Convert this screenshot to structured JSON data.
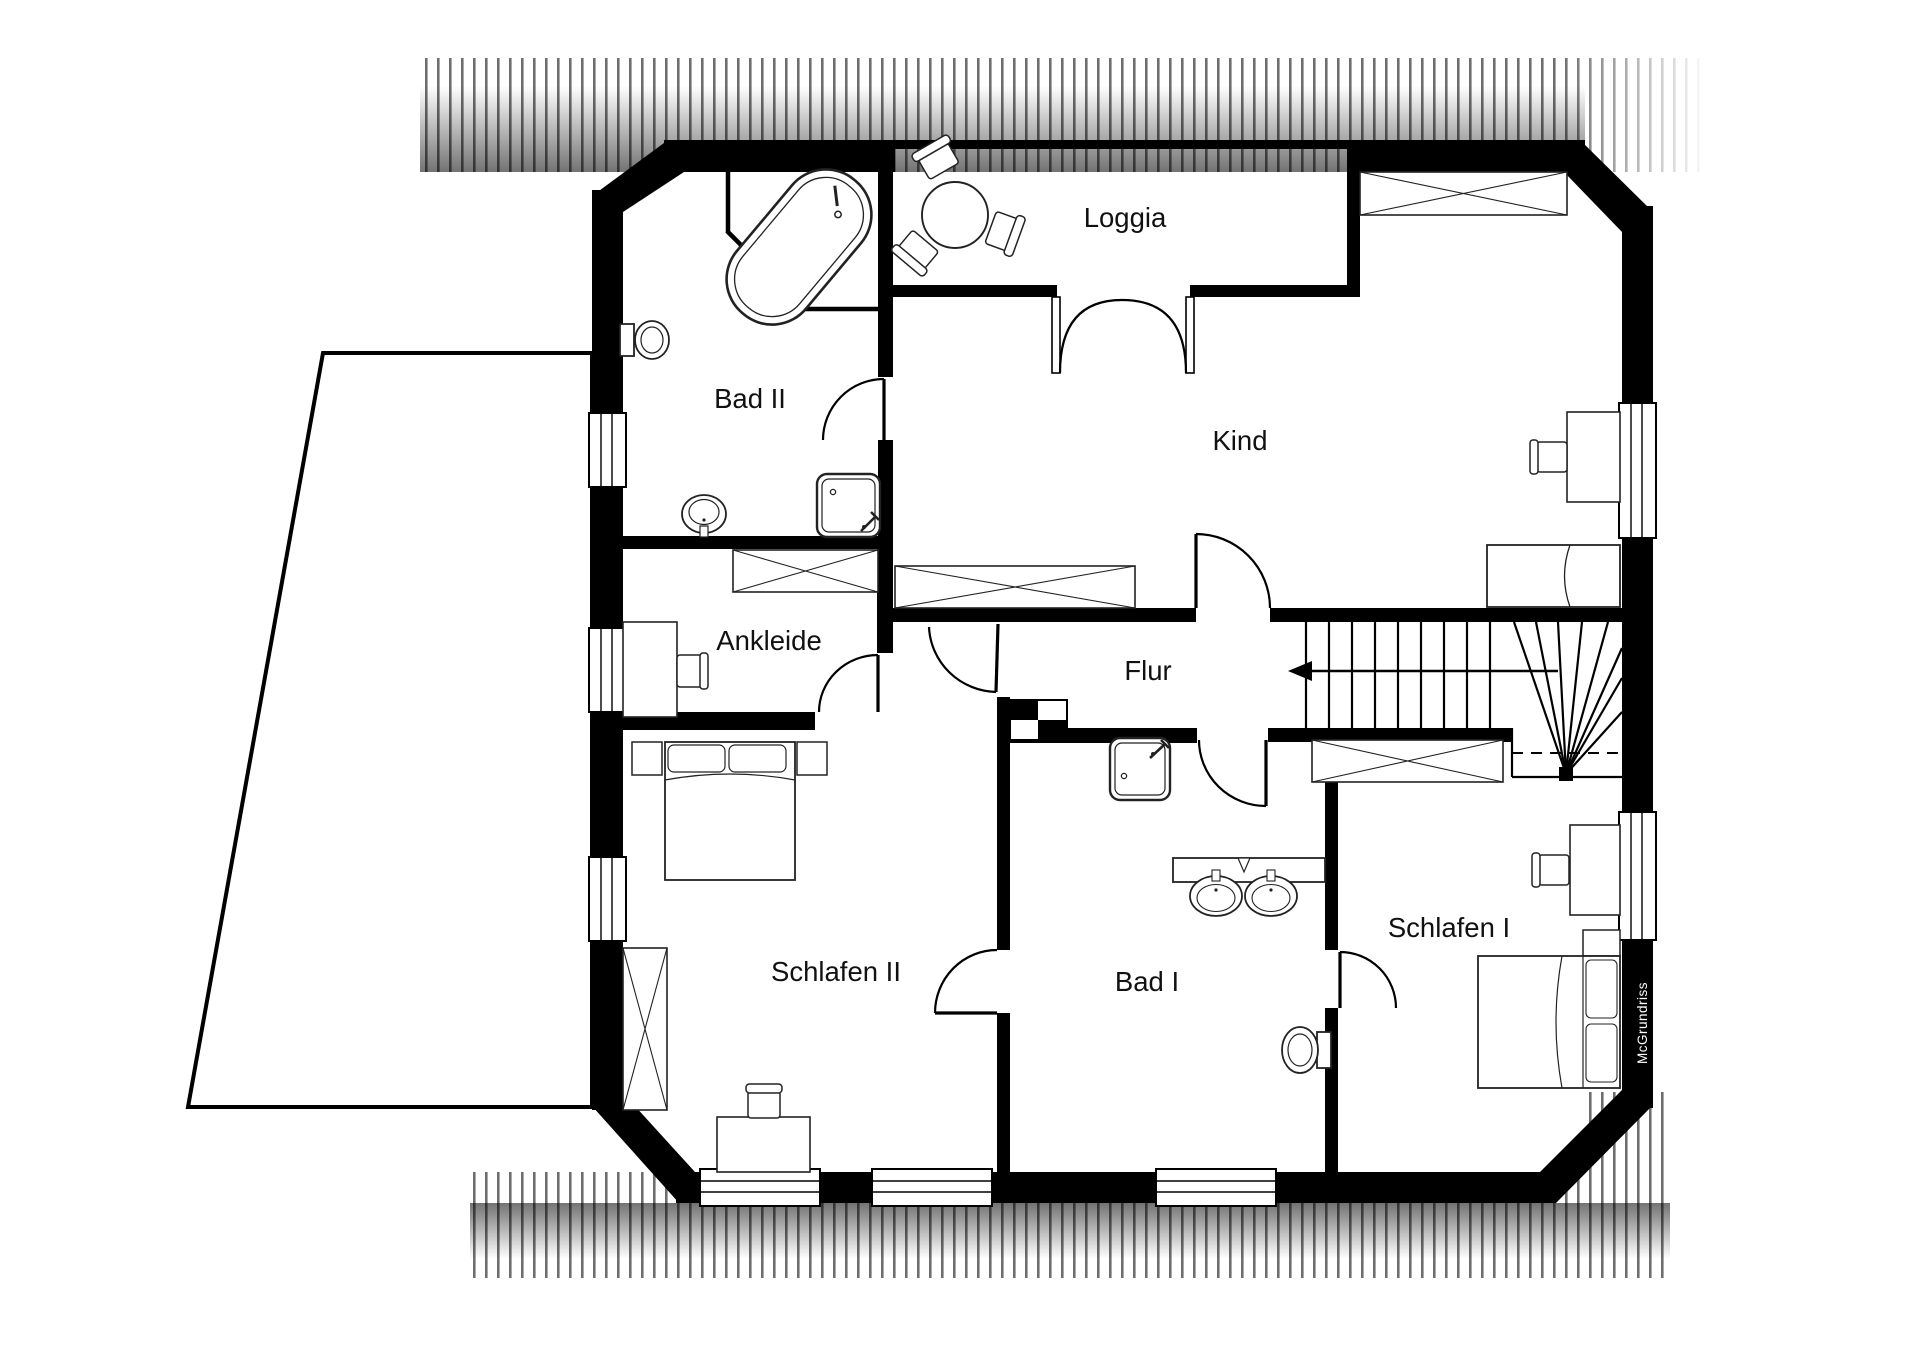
{
  "rooms": {
    "bad2": {
      "label": "Bad II"
    },
    "loggia": {
      "label": "Loggia"
    },
    "kind": {
      "label": "Kind"
    },
    "ankleide": {
      "label": "Ankleide"
    },
    "flur": {
      "label": "Flur"
    },
    "schlafen2": {
      "label": "Schlafen II"
    },
    "bad1": {
      "label": "Bad I"
    },
    "schlafen1": {
      "label": "Schlafen I"
    }
  },
  "watermark": {
    "label": "McGrundriss"
  },
  "colors": {
    "wall": "#000000",
    "background": "#ffffff",
    "hatch_line": "#6e6e6e",
    "furniture_stroke": "#222222",
    "label_text": "#111111",
    "watermark_text": "#ffffff"
  }
}
